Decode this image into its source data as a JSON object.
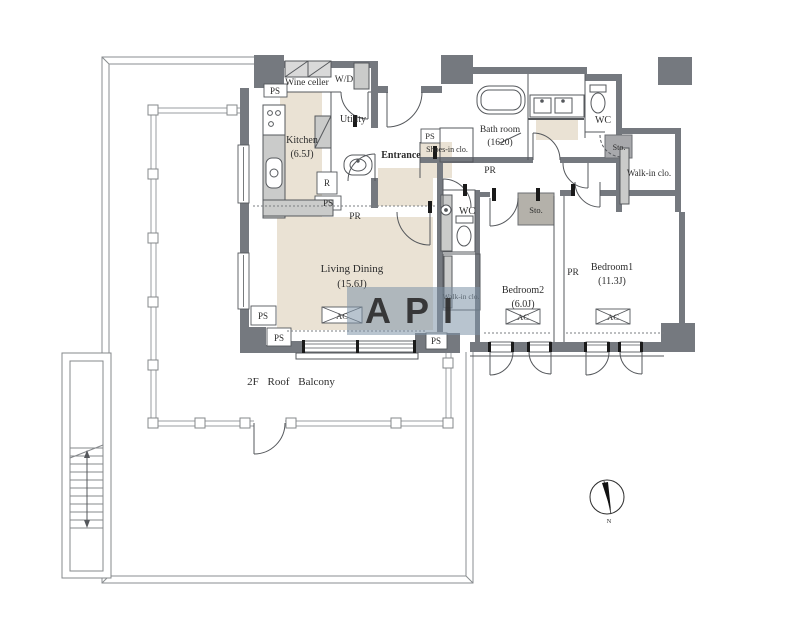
{
  "plan": {
    "balcony_label": "2F  Roof  Balcony",
    "rooms": {
      "wine_cellar": {
        "name": "Wine celler"
      },
      "wd": {
        "name": "W/D"
      },
      "kitchen": {
        "name": "Kitchen",
        "size": "(6.5J)"
      },
      "utility": {
        "name": "Utility"
      },
      "entrance": {
        "name": "Entrance"
      },
      "shoes_closet": {
        "name": "Shoes-in clo."
      },
      "bath_room": {
        "name": "Bath room",
        "size": "(1620)"
      },
      "walk_in_closet": {
        "name": "Walk-in clo."
      },
      "walk_in_closet_small": {
        "name": "Walk-in clo."
      },
      "bedroom1": {
        "name": "Bedroom1",
        "size": "(11.3J)"
      },
      "bedroom2": {
        "name": "Bedroom2",
        "size": "(6.0J)"
      },
      "living_dining": {
        "name": "Living Dining",
        "size": "(15.6J)"
      }
    },
    "tags": {
      "ps": "PS",
      "pr": "PR",
      "wc": "WC",
      "sto": "Sto.",
      "ac": "AC",
      "refrigerator": "R"
    },
    "compass": {
      "north_label": "N"
    },
    "watermark": {
      "text": "API",
      "color": "#7d93a8",
      "text_color": "#f3f2ec"
    },
    "colors": {
      "wall": "#75797f",
      "floor": "#eae2d4",
      "fixture": "#cacbca",
      "storage_box": "#b4b1aa",
      "line": "#55585c",
      "background": "#ffffff"
    }
  }
}
